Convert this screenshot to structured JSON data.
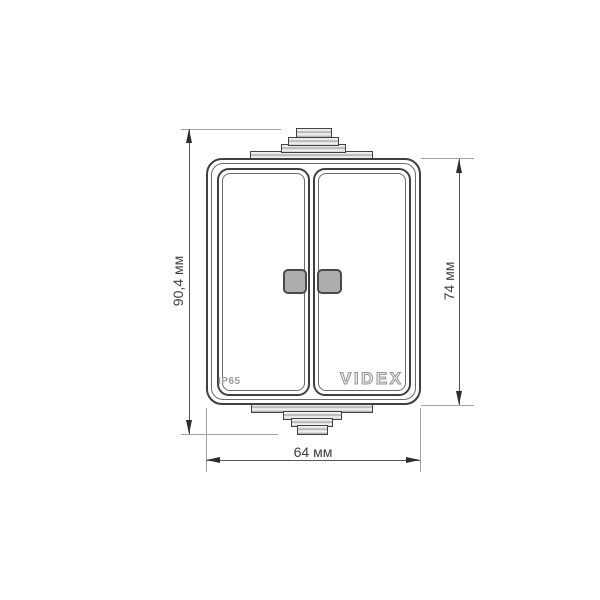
{
  "drawing": {
    "type": "technical-dimension-drawing",
    "product": {
      "brand_logo": "VIDEX",
      "protection_rating": "IP65",
      "gangs": 2,
      "indicator_windows": 2
    },
    "dimensions": {
      "overall_height": "90,4 мм",
      "body_height": "74 мм",
      "body_width": "64 мм"
    },
    "colors": {
      "background": "#ffffff",
      "outline_dark": "#3f3f3f",
      "outline_mid": "#6a6a6a",
      "dim_line": "#555555",
      "ext_line": "#a3a3a3",
      "arrow": "#2e2e2e",
      "label_text": "#3d3d3d",
      "indicator_fill": "#adadad",
      "indicator_border": "#4a4a4a",
      "gland_fill_light": "#efefef",
      "gland_fill_dark": "#aaaaaa",
      "brand_gray": "#949494"
    }
  }
}
